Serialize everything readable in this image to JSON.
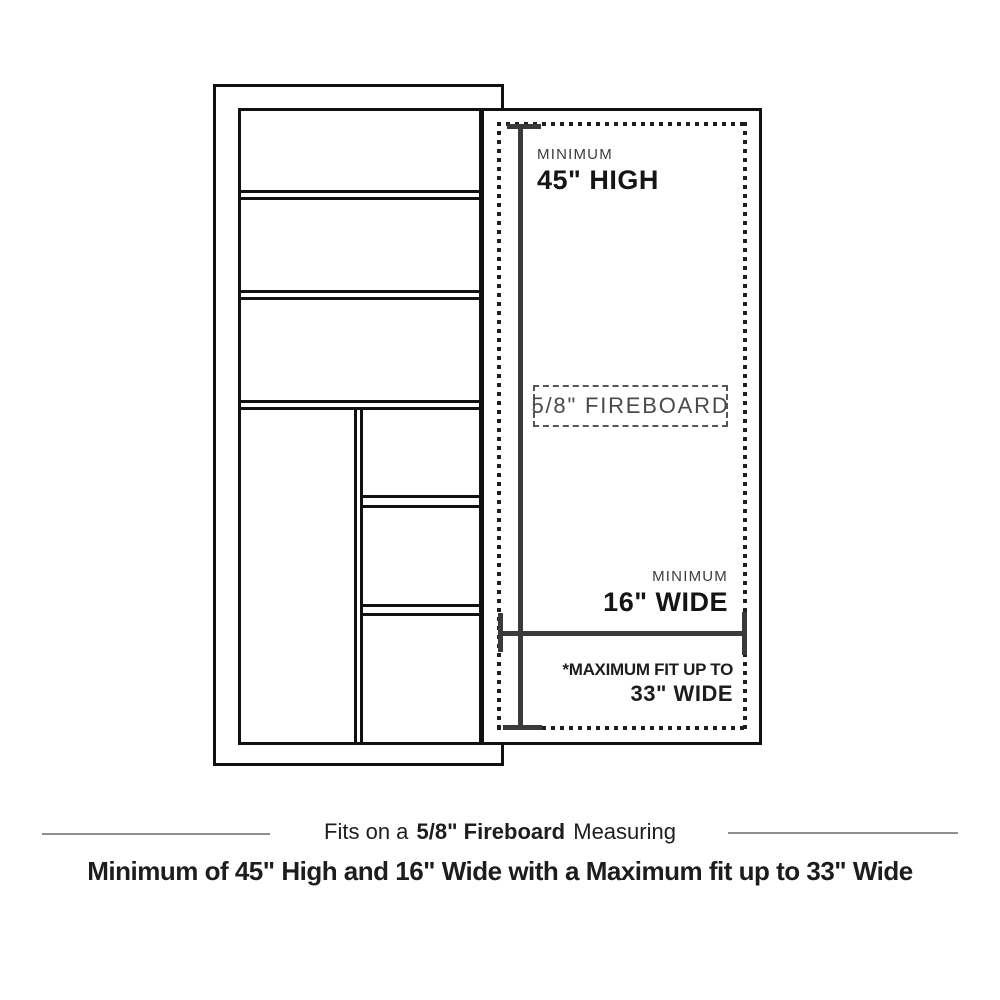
{
  "diagram": {
    "height_measurement": {
      "label_top": "MINIMUM",
      "value": "45\" HIGH"
    },
    "fireboard_box": {
      "label": "5/8\" FIREBOARD"
    },
    "width_measurement": {
      "label_top": "MINIMUM",
      "value": "16\" WIDE"
    },
    "max_fit": {
      "label_top": "*MAXIMUM FIT UP TO",
      "value": "33\" WIDE"
    }
  },
  "caption": {
    "line1_prefix": "Fits on a",
    "line1_bold": "5/8\" Fireboard",
    "line1_suffix": "Measuring",
    "line2": "Minimum of 45\" High and 16\" Wide with a Maximum fit up to 33\" Wide"
  },
  "colors": {
    "outline": "#111111",
    "measure_line": "#3a3a3a",
    "dotted_border": "#1f1f1f",
    "dashed_border": "#555555",
    "light_label": "#3d3d3d",
    "dark_label": "#151515",
    "rule": "#8f8f8f"
  }
}
